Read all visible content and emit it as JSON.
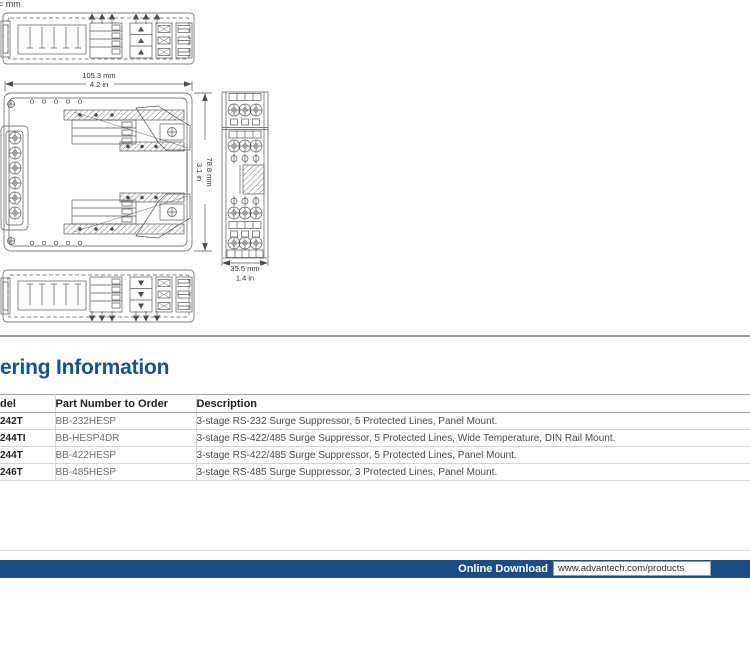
{
  "page": {
    "unit_note": "= mm"
  },
  "drawings": {
    "width_label_mm": "105.3 mm",
    "width_label_in": "4.2 in",
    "height_label_mm": "78.8 mm",
    "height_label_in": "3.1 in",
    "depth_label_mm": "35.5 mm",
    "depth_label_in": "1.4 in"
  },
  "ordering": {
    "heading": "ering Information",
    "table": {
      "headers": [
        "del",
        "Part Number to Order",
        "Description"
      ],
      "rows": [
        {
          "model": "242T",
          "part": "BB-232HESP",
          "description": "3-stage RS-232 Surge Suppressor, 5 Protected Lines, Panel Mount."
        },
        {
          "model": "244TI",
          "part": "BB-HESP4DR",
          "description": "3-stage RS-422/485 Surge Suppressor, 5 Protected Lines, Wide Temperature, DIN Rail Mount."
        },
        {
          "model": "244T",
          "part": "BB-422HESP",
          "description": "3-stage RS-422/485 Surge Suppressor, 5 Protected Lines, Panel Mount."
        },
        {
          "model": "246T",
          "part": "BB-485HESP",
          "description": "3-stage RS-485 Surge Suppressor, 3 Protected Lines, Panel Mount."
        }
      ]
    }
  },
  "footer": {
    "label": "Online Download",
    "url": "www.advantech.com/products",
    "bar_color": "#1d4d86"
  },
  "colors": {
    "heading_blue": "#1b5191",
    "drawing_stroke": "#55575b",
    "divider_gray": "#939598"
  }
}
